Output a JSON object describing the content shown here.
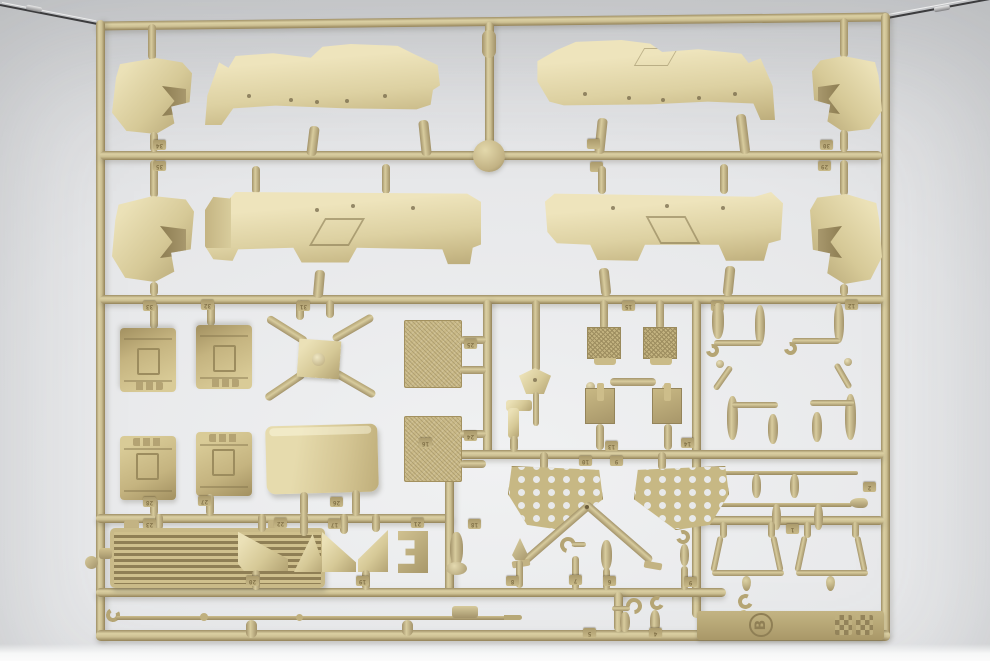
{
  "scene": {
    "type": "photograph",
    "subject": "tan plastic model-kit parts sprue hanging on wires",
    "sprue_letter": "B"
  },
  "colors": {
    "plastic_tan": "#d5c795",
    "plastic_shadow": "#97875d",
    "plastic_highlight": "#eee4bc",
    "background_gray": "#d9dadc"
  },
  "tags": [
    {
      "label": "34"
    },
    {
      "label": "35"
    },
    {
      "label": "30"
    },
    {
      "label": "29"
    },
    {
      "label": "33"
    },
    {
      "label": "32"
    },
    {
      "label": "31"
    },
    {
      "label": "15"
    },
    {
      "label": "11"
    },
    {
      "label": "12"
    },
    {
      "label": "25"
    },
    {
      "label": "24"
    },
    {
      "label": "16"
    },
    {
      "label": "13"
    },
    {
      "label": "14"
    },
    {
      "label": "10"
    },
    {
      "label": "9"
    },
    {
      "label": "3"
    },
    {
      "label": "2"
    },
    {
      "label": "28"
    },
    {
      "label": "27"
    },
    {
      "label": "26"
    },
    {
      "label": "23"
    },
    {
      "label": "22"
    },
    {
      "label": "17"
    },
    {
      "label": "21"
    },
    {
      "label": "18"
    },
    {
      "label": "1"
    },
    {
      "label": "20"
    },
    {
      "label": "19"
    },
    {
      "label": "8"
    },
    {
      "label": "7"
    },
    {
      "label": "6"
    },
    {
      "label": "9"
    },
    {
      "label": "5"
    },
    {
      "label": "4"
    }
  ]
}
